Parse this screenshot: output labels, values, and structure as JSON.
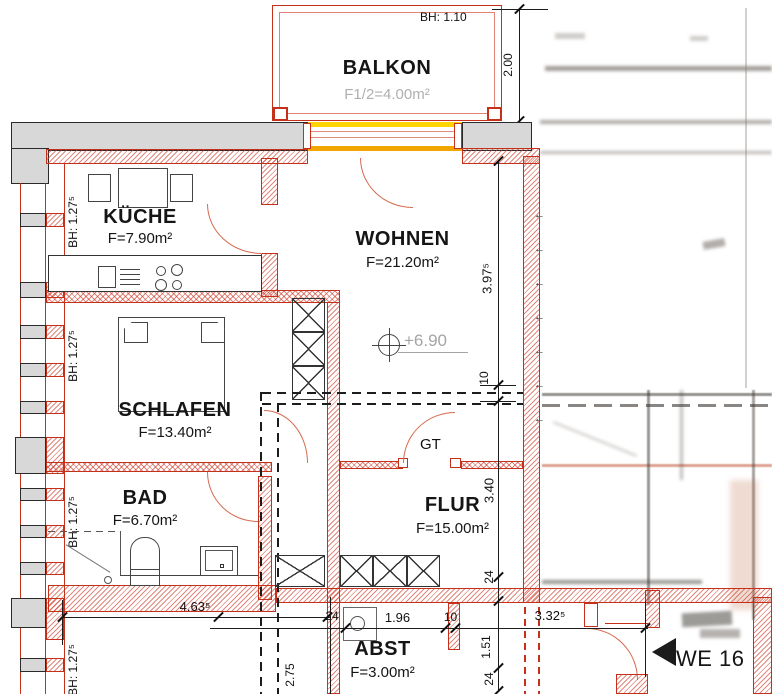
{
  "drawing": {
    "type": "architectural floor plan"
  },
  "rooms": {
    "balkon": {
      "name": "BALKON",
      "area": "F1/2=4.00m²",
      "parapet": "BH: 1.10"
    },
    "kueche": {
      "name": "KÜCHE",
      "area": "F=7.90m²"
    },
    "wohnen": {
      "name": "WOHNEN",
      "area": "F=21.20m²"
    },
    "schlafen": {
      "name": "SCHLAFEN",
      "area": "F=13.40m²"
    },
    "bad": {
      "name": "BAD",
      "area": "F=6.70m²"
    },
    "flur": {
      "name": "FLUR",
      "area": "F=15.00m²"
    },
    "abst": {
      "name": "ABST",
      "area": "F=3.00m²"
    }
  },
  "annotations": {
    "parapet_left": "BH: 1.27⁵",
    "level_mark": "+6.90",
    "door_tag": "GT",
    "unit_tag": "WE 16"
  },
  "dimensions": {
    "balcony_depth": "2.00",
    "wohnen_height": "3.97⁵",
    "wall_10_top": "10",
    "flur_height": "3.40",
    "wall_24_right": "24",
    "entry_151": "1.51",
    "wall_24_bottom": "24",
    "bottom_width": "4.63⁵",
    "wall_24_left": "24",
    "abst_width": "1.96",
    "jamb_10": "10",
    "entry_width": "3.32⁵",
    "left_275": "2.75"
  },
  "colors": {
    "wall_red": "#c5301a",
    "wall_gray": "#d8d8d8",
    "window_yellow": "#ffd400",
    "window_orange": "#f2a400",
    "text": "#151515",
    "muted_text": "#b0b0b0"
  }
}
